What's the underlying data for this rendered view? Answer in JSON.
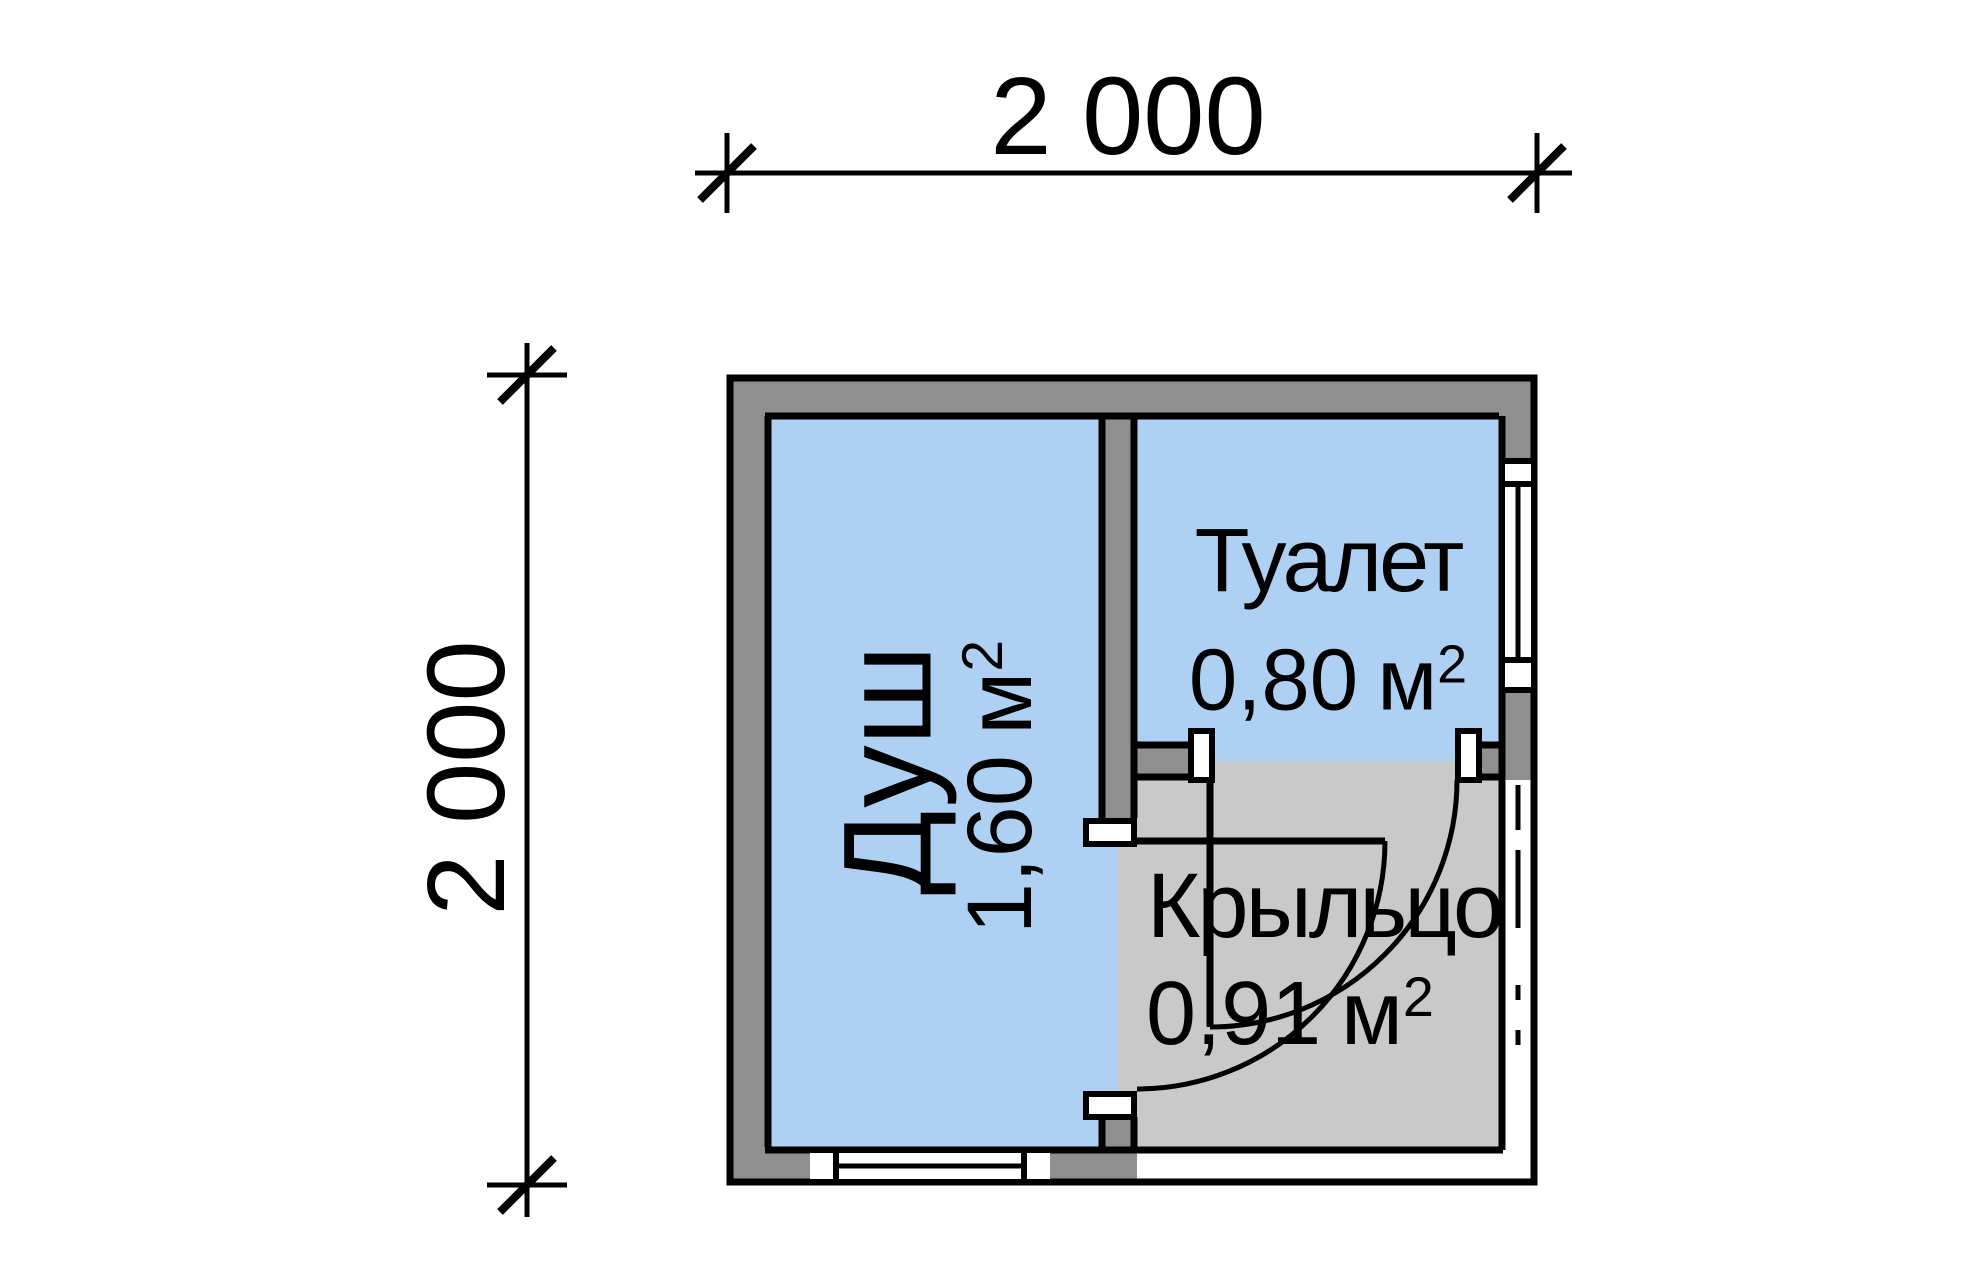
{
  "dimensions": {
    "top_label": "2 000",
    "left_label": "2 000"
  },
  "rooms": {
    "shower": {
      "name": "Душ",
      "area_value": "1,60",
      "area_unit": "м",
      "area_exponent": "2"
    },
    "toilet": {
      "name": "Туалет",
      "area_value": "0,80",
      "area_unit": "м",
      "area_exponent": "2"
    },
    "porch": {
      "name": "Крыльцо",
      "area_value": "0,91",
      "area_unit": "м",
      "area_exponent": "2"
    }
  },
  "colors": {
    "room_fill": "#aed0f2",
    "porch_fill": "#c9c9c9",
    "wall_fill": "#8f8f8f",
    "line": "#000000",
    "background": "#ffffff"
  }
}
